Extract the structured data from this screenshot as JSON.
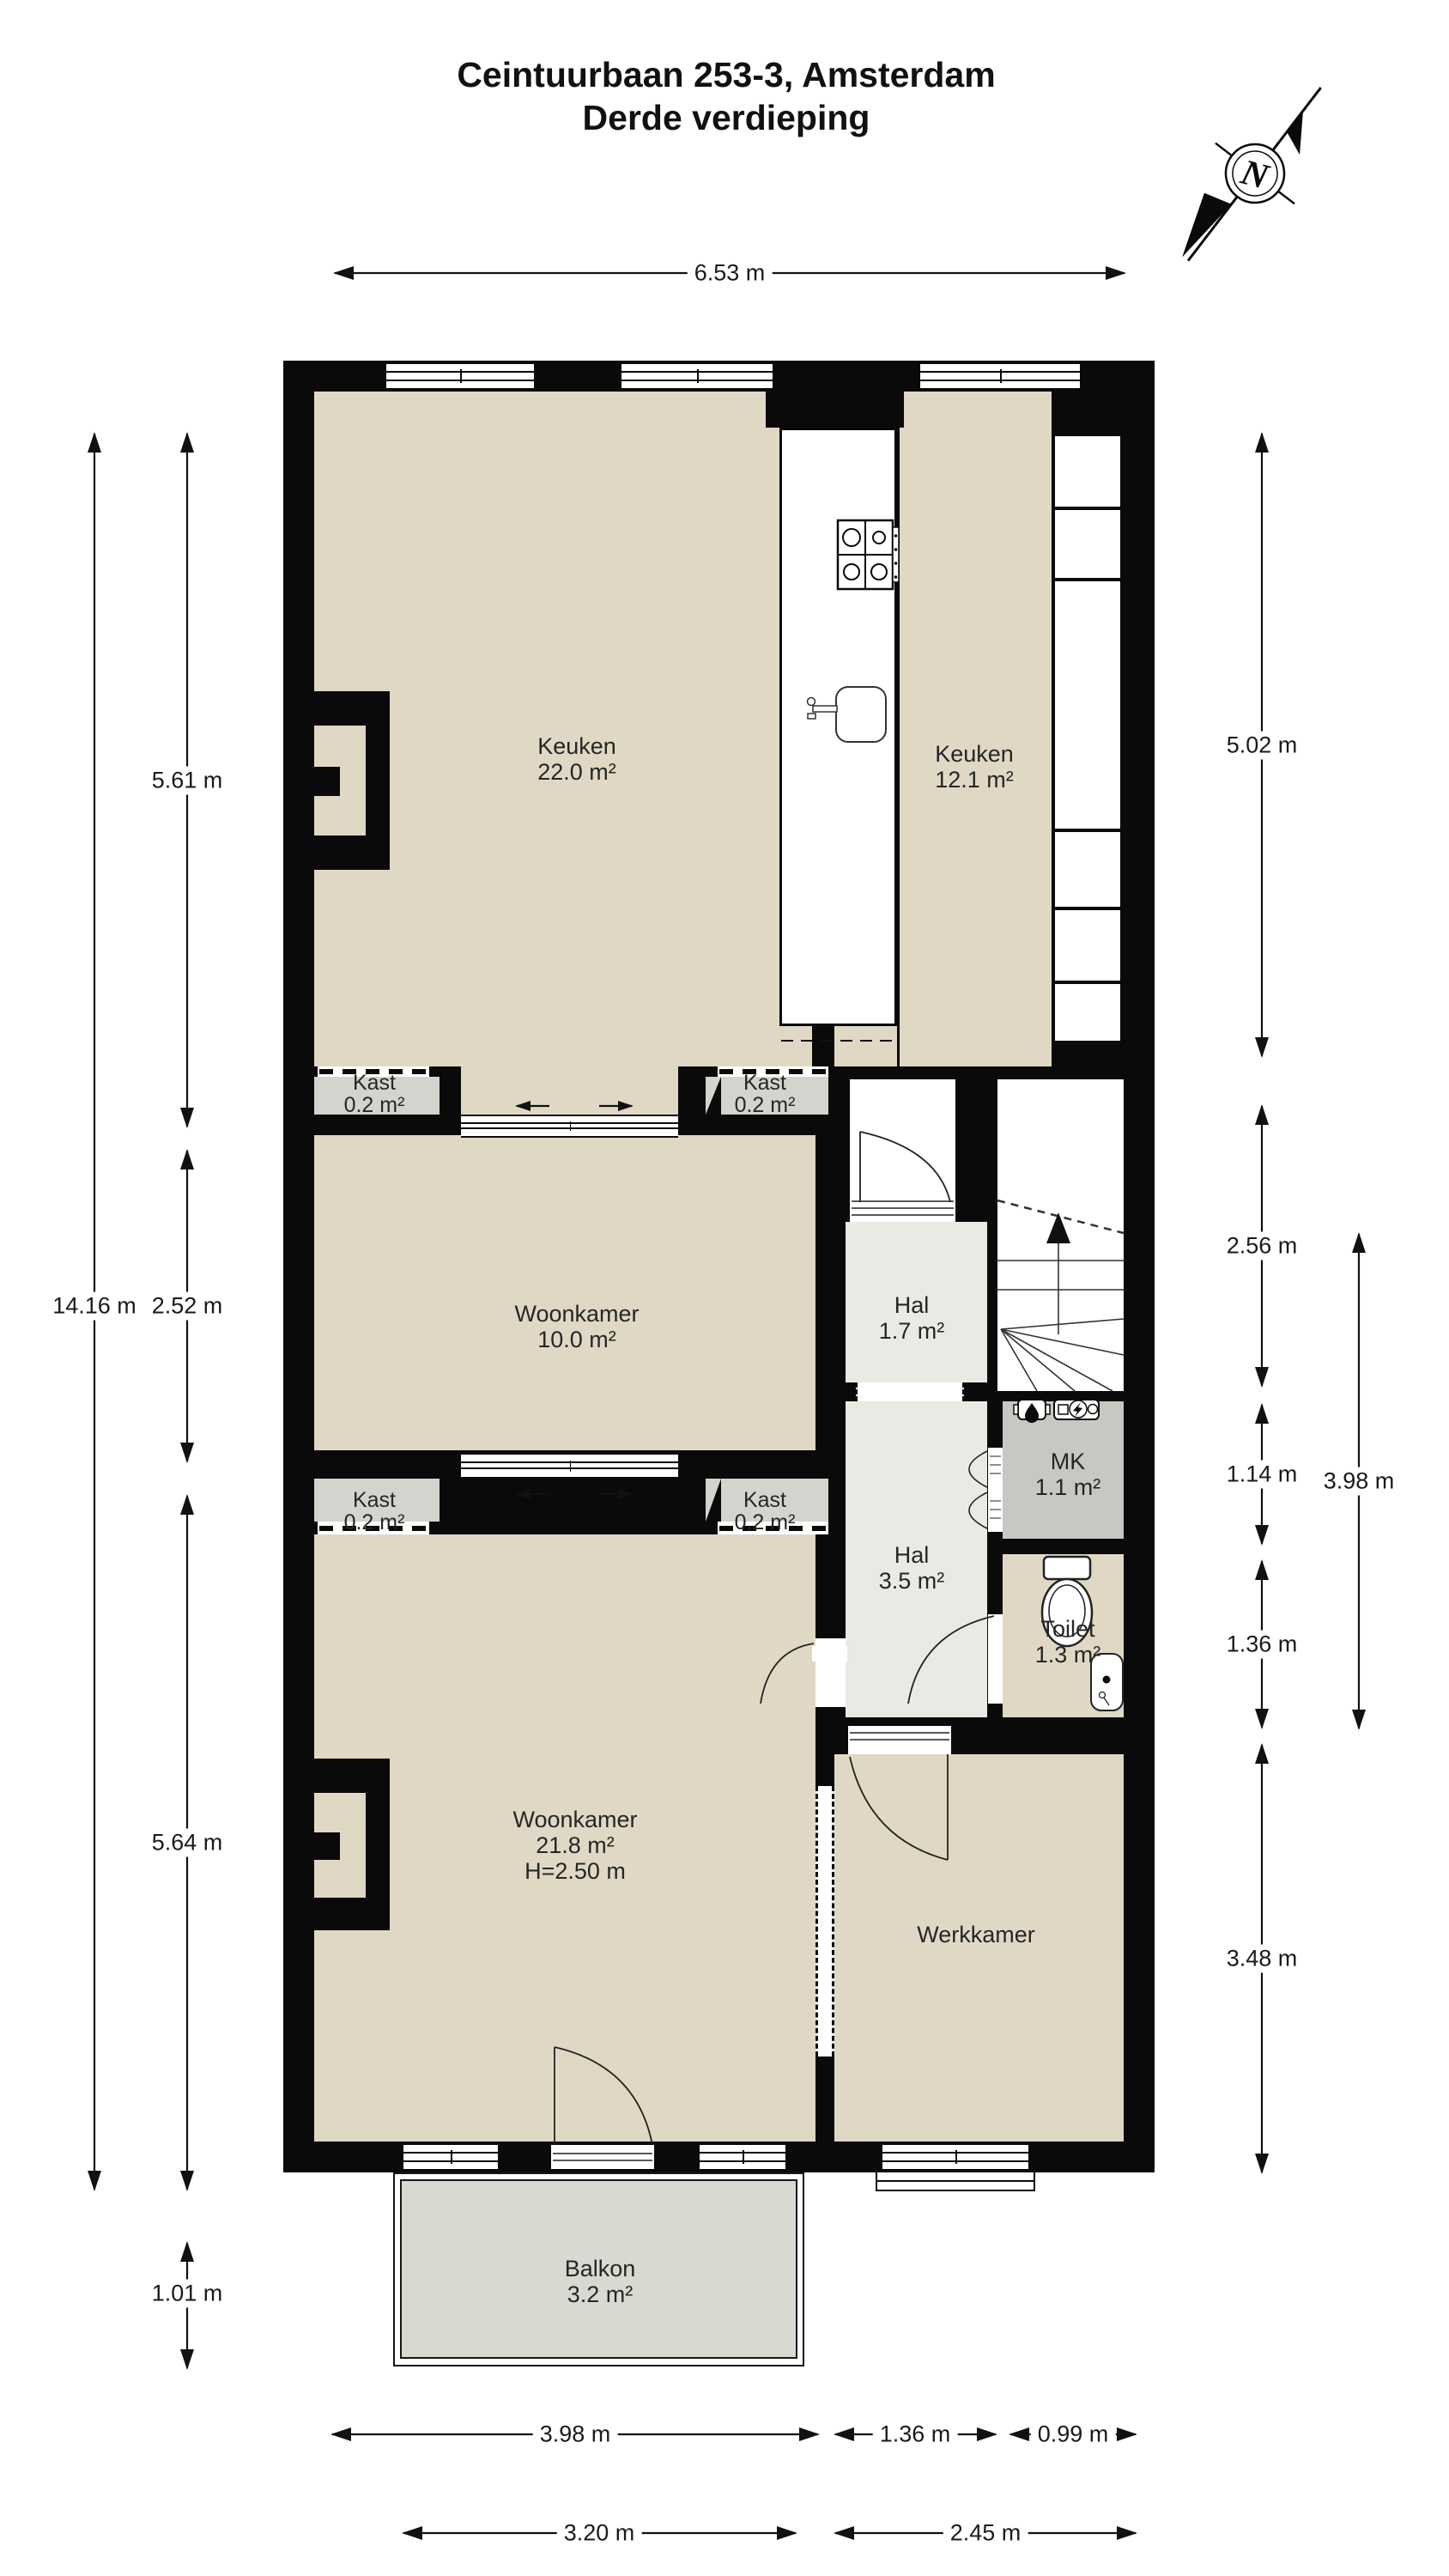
{
  "title": {
    "line1": "Ceintuurbaan 253-3, Amsterdam",
    "line2": "Derde verdieping"
  },
  "compass": {
    "label": "N"
  },
  "rooms": {
    "keuken_groot": {
      "name": "Keuken",
      "area": "22.0 m²"
    },
    "keuken_klein": {
      "name": "Keuken",
      "area": "12.1 m²"
    },
    "kast_1": {
      "name": "Kast",
      "area": "0.2 m²"
    },
    "kast_2": {
      "name": "Kast",
      "area": "0.2 m²"
    },
    "kast_3": {
      "name": "Kast",
      "area": "0.2 m²"
    },
    "kast_4": {
      "name": "Kast",
      "area": "0.2 m²"
    },
    "woonkamer_klein": {
      "name": "Woonkamer",
      "area": "10.0 m²"
    },
    "hal_klein": {
      "name": "Hal",
      "area": "1.7 m²"
    },
    "mk": {
      "name": "MK",
      "area": "1.1 m²"
    },
    "hal_groot": {
      "name": "Hal",
      "area": "3.5 m²"
    },
    "toilet": {
      "name": "Toilet",
      "area": "1.3 m²"
    },
    "woonkamer_groot": {
      "name": "Woonkamer",
      "area": "21.8 m²",
      "ceiling_height": "H=2.50 m"
    },
    "werkkamer": {
      "name": "Werkkamer"
    },
    "balkon": {
      "name": "Balkon",
      "area": "3.2 m²"
    }
  },
  "dimensions": {
    "top_width": "6.53 m",
    "left_total": "14.16 m",
    "left_keuken": "5.61 m",
    "left_woonkamer_klein": "2.52 m",
    "left_woonkamer_groot": "5.64 m",
    "left_balkon": "1.01 m",
    "right_keuken": "5.02 m",
    "right_hal": "2.56 m",
    "right_mk": "1.14 m",
    "right_toilet": "1.36 m",
    "right_werkkamer": "3.48 m",
    "right_outer": "3.98 m",
    "bottom_woonkamer": "3.98 m",
    "bottom_hal": "1.36 m",
    "bottom_toilet": "0.99 m",
    "bottom_balkon": "3.20 m",
    "bottom_werkkamer": "2.45 m"
  },
  "colors": {
    "wall": "#0a0a0a",
    "floor": "#e0d8c5",
    "kast_floor": "#d3d4ce",
    "hal_floor": "#ebe9e4",
    "mk_floor": "#c6c8c1",
    "balkon_floor": "#d9d8d1",
    "line": "#111111"
  }
}
